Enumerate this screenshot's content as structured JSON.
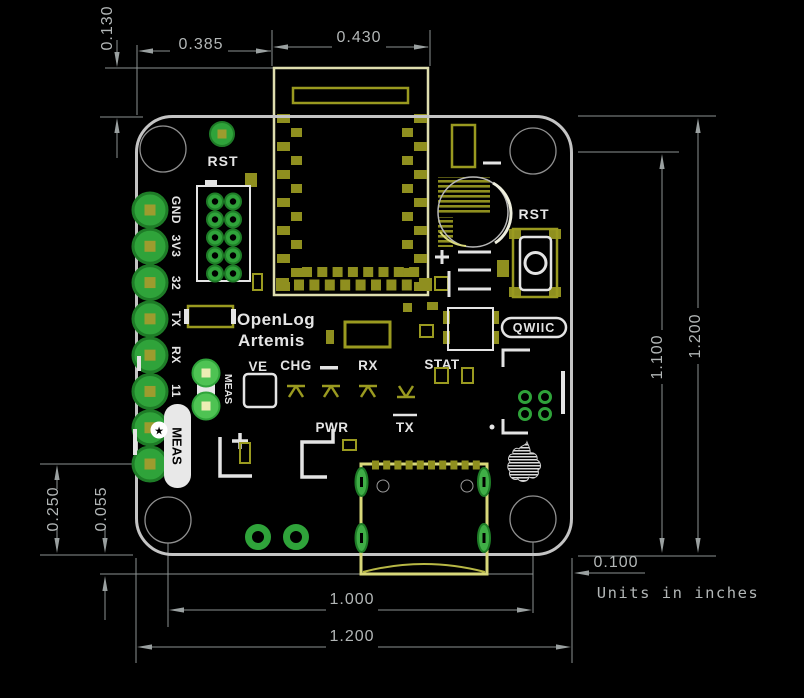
{
  "dims": {
    "d130": "0.130",
    "d385": "0.385",
    "d430": "0.430",
    "d1200r": "1.200",
    "d1100": "1.100",
    "d250": "0.250",
    "d055": "0.055",
    "d1000": "1.000",
    "d1200b": "1.200",
    "d100": "0.100",
    "units": "Units in inches"
  },
  "silk": {
    "rst_top": "RST",
    "rst_btn": "RST",
    "name1": "OpenLog",
    "name2": "Artemis",
    "ve": "VE",
    "chg": "CHG",
    "rx": "RX",
    "stat": "STAT",
    "pwr": "PWR",
    "tx": "TX",
    "qwiic": "QWIIC",
    "meas_badge": "MEAS",
    "meas_jumper": "MEAS",
    "star": "★",
    "pins": [
      "GND",
      "3V3",
      "32",
      "TX",
      "RX",
      "11"
    ]
  },
  "colors": {
    "pad_green": "#2fa33a",
    "bright_green": "#4ec353",
    "silk_yellow": "#8f8f1f",
    "pale_yellow": "#d8d87a",
    "silk_white": "#e4e4e4",
    "dim_line": "#8c9292",
    "dim_text": "#b2b6b6",
    "board_edge": "#c4c4c4"
  }
}
